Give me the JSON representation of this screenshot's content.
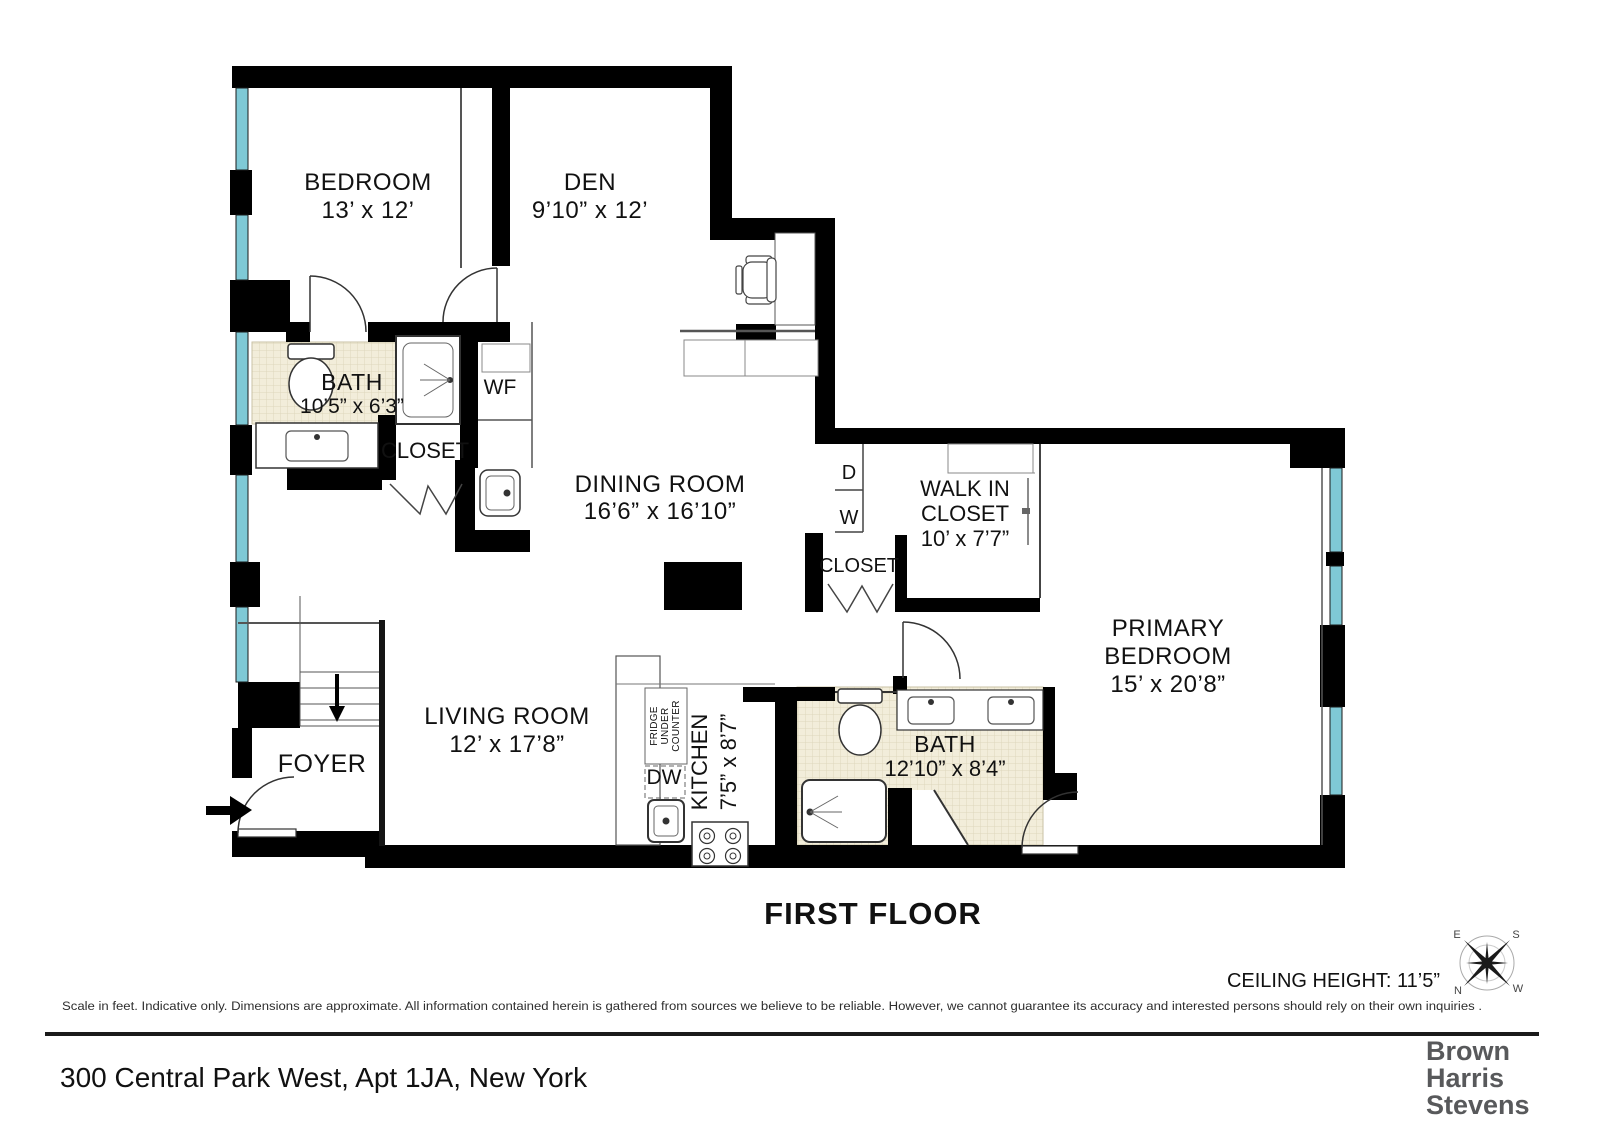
{
  "plan": {
    "title": "FIRST FLOOR",
    "ceiling_height": "CEILING HEIGHT: 11’5”",
    "compass": {
      "e": "E",
      "s": "S",
      "n": "N",
      "w": "W"
    },
    "rooms": {
      "bedroom": {
        "name": "BEDROOM",
        "dims": "13’ x 12’"
      },
      "den": {
        "name": "DEN",
        "dims": "9’10” x 12’"
      },
      "bath1": {
        "name": "BATH",
        "dims": "10’5” x 6’3”"
      },
      "wf": {
        "label": "WF"
      },
      "closet1": {
        "label": "CLOSET"
      },
      "dining": {
        "name": "DINING ROOM",
        "dims": "16’6” x 16’10”"
      },
      "dryer": {
        "label": "D"
      },
      "washer": {
        "label": "W"
      },
      "walkin": {
        "line1": "WALK IN",
        "line2": "CLOSET",
        "dims": "10’ x 7’7”"
      },
      "closet2": {
        "label": "CLOSET"
      },
      "primary": {
        "line1": "PRIMARY",
        "line2": "BEDROOM",
        "dims": "15’ x 20’8”"
      },
      "living": {
        "name": "LIVING ROOM",
        "dims": "12’ x 17’8”"
      },
      "foyer": {
        "name": "FOYER"
      },
      "kitchen": {
        "name": "KITCHEN",
        "dims": "7’5” x 8’7”"
      },
      "dw": {
        "label": "DW"
      },
      "fridge": {
        "line1": "FRIDGE",
        "line2": "UNDER",
        "line3": "COUNTER"
      },
      "bath2": {
        "name": "BATH",
        "dims": "12’10” x 8’4”"
      }
    },
    "icons": {
      "compass": "compass-rose-icon",
      "entry_arrow": "entry-arrow-icon",
      "stairs_arrow": "stairs-down-arrow-icon"
    },
    "footer": {
      "disclaimer": "Scale in feet. Indicative only. Dimensions are approximate. All information contained herein is gathered from sources we believe to be reliable. However, we cannot guarantee its accuracy and interested persons should rely on their own inquiries .",
      "address": "300 Central Park West, Apt 1JA, New York",
      "brand_line1": "Brown",
      "brand_line2": "Harris",
      "brand_line3": "Stevens"
    },
    "colors": {
      "wall": "#000000",
      "window": "#7fc9d6",
      "tile": "#f2edda",
      "brand": "#58595b"
    }
  }
}
